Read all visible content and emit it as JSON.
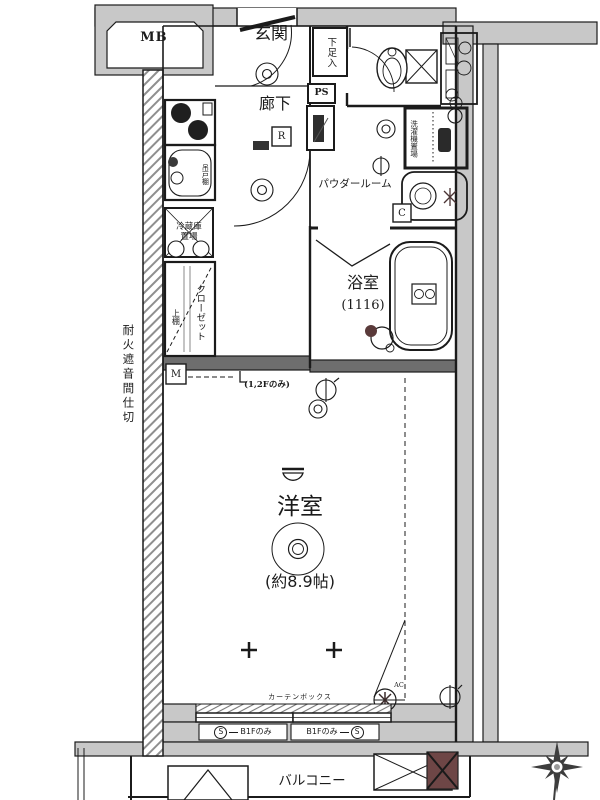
{
  "labels": {
    "mb": "MB",
    "genkan": "玄関",
    "shoe": "下足入",
    "rouka": "廊下",
    "ps": "PS",
    "powder": "パウダールーム",
    "laundry": "洗濯機置場",
    "hanging_cabinet": "吊戸棚",
    "fridge_line1": "冷蔵庫",
    "fridge_line2": "置場",
    "closet": "クローゼット",
    "shelf": "上棚",
    "bath": "浴室",
    "bath_size": "(1116)",
    "partition": "耐火遮音間仕切",
    "room": "洋室",
    "room_size": "(約8.9帖)",
    "floor_note": "(1,2Fのみ)",
    "curtain": "カーテンボックス",
    "shutter_s": "S",
    "shutter_note": "B1Fのみ",
    "balcony": "バルコニー",
    "mark_r": "R",
    "mark_c": "C",
    "mark_m": "M",
    "mark_ac": "AC"
  },
  "colors": {
    "wall_gray": "#c8c8c8",
    "wall_dark": "#6e6e6e",
    "accent_dark_box": "#6e4646",
    "line": "#1b1b1b"
  }
}
